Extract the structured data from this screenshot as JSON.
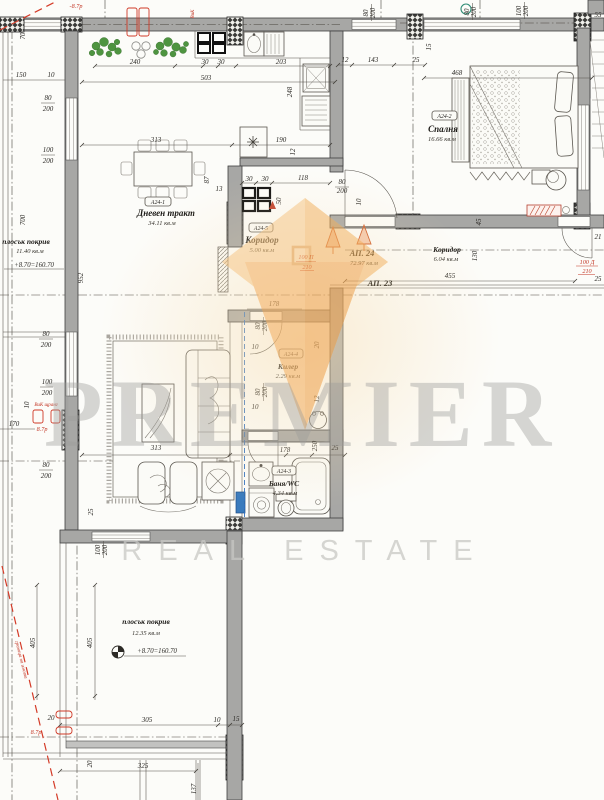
{
  "watermark": {
    "brand": "PREMIER",
    "tagline": "REAL ESTATE"
  },
  "apartment": {
    "id": "АП. 24",
    "area": "72.97 кв.м"
  },
  "neighbor": {
    "id": "АП. 23"
  },
  "rooms": {
    "living": {
      "code": "A24-1",
      "name": "Дневен тракт",
      "area": "34.11 кв.м"
    },
    "bedroom": {
      "code": "A24-2",
      "name": "Спалня",
      "area": "16.66 кв.м"
    },
    "bath": {
      "code": "A24-3",
      "name": "Баня/WC",
      "area": "4.34 кв.м"
    },
    "storage": {
      "code": "A24-4",
      "name": "Килер",
      "area": "2.29 кв.м"
    },
    "hall": {
      "code": "A24-5",
      "name": "Коридор",
      "area": "5.00 кв.м"
    },
    "corridor": {
      "name": "Коридор",
      "area": "6.04 кв.м"
    }
  },
  "roof_left": {
    "name": "плосък покрив",
    "area": "11.40 кв.м",
    "level": "+8.70=160.70"
  },
  "roof_bottom": {
    "name": "плосък покрив",
    "area": "12.35 кв.м",
    "level": "+8.70=160.70"
  },
  "red_labels": {
    "top_level": "-8.7р",
    "mid_level": "8.7р",
    "bottom_level": "8.7р",
    "riser": "ВиК",
    "riser_note": "ВиК щранг",
    "boundary": "граница на имота",
    "entry_door_w": "100 П",
    "entry_door_h": "210",
    "hall_door_w": "100 Д",
    "hall_door_h": "210"
  },
  "dims": [
    {
      "t": "240",
      "x": 135,
      "y": 64
    },
    {
      "t": "30",
      "x": 205,
      "y": 64
    },
    {
      "t": "30",
      "x": 221,
      "y": 64
    },
    {
      "t": "203",
      "x": 281,
      "y": 64
    },
    {
      "t": "503",
      "x": 206,
      "y": 80
    },
    {
      "t": "12",
      "x": 345,
      "y": 62
    },
    {
      "t": "143",
      "x": 373,
      "y": 62
    },
    {
      "t": "25",
      "x": 416,
      "y": 62
    },
    {
      "t": "468",
      "x": 457,
      "y": 75
    },
    {
      "t": "55",
      "x": 598,
      "y": 17
    },
    {
      "t": "150",
      "x": 21,
      "y": 77
    },
    {
      "t": "10",
      "x": 51,
      "y": 77
    },
    {
      "t": "70",
      "x": 25,
      "y": 36,
      "r": -90
    },
    {
      "t": "80",
      "x": 48,
      "y": 100
    },
    {
      "t": "200",
      "x": 48,
      "y": 111
    },
    {
      "t": "100",
      "x": 48,
      "y": 152
    },
    {
      "t": "200",
      "x": 48,
      "y": 163
    },
    {
      "t": "80",
      "x": 368,
      "y": 13,
      "r": -90
    },
    {
      "t": "200",
      "x": 375,
      "y": 13,
      "r": -90
    },
    {
      "t": "80",
      "x": 469,
      "y": 12,
      "r": -90
    },
    {
      "t": "200",
      "x": 476,
      "y": 12,
      "r": -90
    },
    {
      "t": "100",
      "x": 521,
      "y": 11,
      "r": -90
    },
    {
      "t": "200",
      "x": 528,
      "y": 11,
      "r": -90
    },
    {
      "t": "15",
      "x": 431,
      "y": 47,
      "r": -90
    },
    {
      "t": "248",
      "x": 292,
      "y": 92,
      "r": -90
    },
    {
      "t": "313",
      "x": 156,
      "y": 142
    },
    {
      "t": "190",
      "x": 281,
      "y": 142
    },
    {
      "t": "12",
      "x": 295,
      "y": 152,
      "r": -90
    },
    {
      "t": "87",
      "x": 209,
      "y": 180,
      "r": -90
    },
    {
      "t": "13",
      "x": 219,
      "y": 191
    },
    {
      "t": "30",
      "x": 249,
      "y": 181
    },
    {
      "t": "30",
      "x": 265,
      "y": 181
    },
    {
      "t": "118",
      "x": 303,
      "y": 180
    },
    {
      "t": "50",
      "x": 281,
      "y": 201,
      "r": -90
    },
    {
      "t": "80",
      "x": 342,
      "y": 184
    },
    {
      "t": "200",
      "x": 342,
      "y": 193
    },
    {
      "t": "10",
      "x": 361,
      "y": 202,
      "r": -90
    },
    {
      "t": "455",
      "x": 450,
      "y": 278
    },
    {
      "t": "130",
      "x": 477,
      "y": 256,
      "r": -90
    },
    {
      "t": "45",
      "x": 481,
      "y": 222,
      "r": -90
    },
    {
      "t": "21",
      "x": 598,
      "y": 239
    },
    {
      "t": "25",
      "x": 598,
      "y": 281
    },
    {
      "t": "178",
      "x": 274,
      "y": 306
    },
    {
      "t": "80",
      "x": 260,
      "y": 326,
      "r": -90
    },
    {
      "t": "200",
      "x": 267,
      "y": 326,
      "r": -90
    },
    {
      "t": "10",
      "x": 255,
      "y": 349
    },
    {
      "t": "20",
      "x": 319,
      "y": 345,
      "r": -90
    },
    {
      "t": "80",
      "x": 260,
      "y": 392,
      "r": -90
    },
    {
      "t": "200",
      "x": 267,
      "y": 392,
      "r": -90
    },
    {
      "t": "10",
      "x": 255,
      "y": 409
    },
    {
      "t": "12",
      "x": 319,
      "y": 399,
      "r": -90
    },
    {
      "t": "250",
      "x": 317,
      "y": 446,
      "r": -90
    },
    {
      "t": "313",
      "x": 156,
      "y": 450
    },
    {
      "t": "178",
      "x": 285,
      "y": 452
    },
    {
      "t": "25",
      "x": 335,
      "y": 450
    },
    {
      "t": "25",
      "x": 93,
      "y": 512,
      "r": -90
    },
    {
      "t": "100",
      "x": 100,
      "y": 550,
      "r": -90
    },
    {
      "t": "200",
      "x": 107,
      "y": 550,
      "r": -90
    },
    {
      "t": "80",
      "x": 46,
      "y": 336
    },
    {
      "t": "200",
      "x": 46,
      "y": 347
    },
    {
      "t": "100",
      "x": 47,
      "y": 384
    },
    {
      "t": "200",
      "x": 47,
      "y": 395
    },
    {
      "t": "80",
      "x": 46,
      "y": 467
    },
    {
      "t": "200",
      "x": 46,
      "y": 478
    },
    {
      "t": "170",
      "x": 14,
      "y": 426
    },
    {
      "t": "10",
      "x": 29,
      "y": 405,
      "r": -90
    },
    {
      "t": "700",
      "x": 25,
      "y": 220,
      "r": -90
    },
    {
      "t": "952",
      "x": 83,
      "y": 278,
      "r": -90
    },
    {
      "t": "405",
      "x": 35,
      "y": 643,
      "r": -90
    },
    {
      "t": "405",
      "x": 92,
      "y": 643,
      "r": -90
    },
    {
      "t": "20",
      "x": 51,
      "y": 720
    },
    {
      "t": "20",
      "x": 92,
      "y": 764,
      "r": -90
    },
    {
      "t": "305",
      "x": 147,
      "y": 722
    },
    {
      "t": "10",
      "x": 217,
      "y": 722
    },
    {
      "t": "15",
      "x": 236,
      "y": 721
    },
    {
      "t": "325",
      "x": 143,
      "y": 768
    },
    {
      "t": "137",
      "x": 196,
      "y": 789,
      "r": -90
    }
  ]
}
